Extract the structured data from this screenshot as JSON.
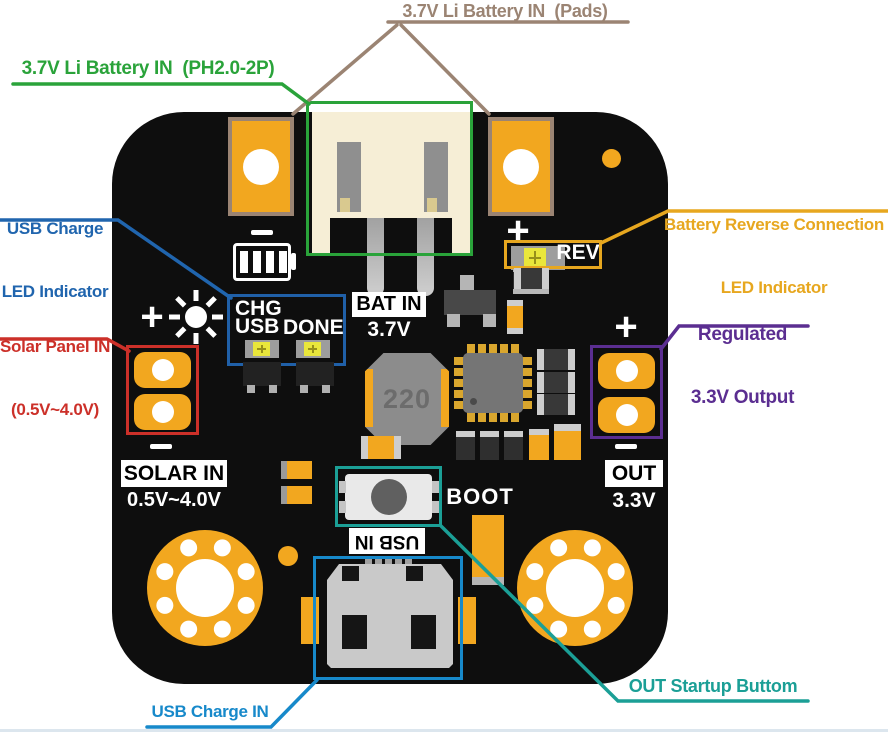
{
  "annotations": {
    "battery_pads": "3.7V Li Battery IN  (Pads)",
    "battery_connector": "3.7V Li Battery IN  (PH2.0-2P)",
    "usb_charge_led_1": "USB Charge",
    "usb_charge_led_2": "LED Indicator",
    "battery_reverse_1": "Battery Reverse Connection",
    "battery_reverse_2": "LED Indicator",
    "solar_panel_1": "Solar Panel IN",
    "solar_panel_2": "(0.5V~4.0V)",
    "regulated_1": "Regulated",
    "regulated_2": "3.3V Output",
    "out_startup": "OUT Startup Buttom",
    "usb_charge_in": "USB Charge IN"
  },
  "silkscreen": {
    "rev": "REV",
    "chg": "CHG",
    "usb": "USB",
    "done": "DONE",
    "bat_in": "BAT IN",
    "bat_voltage": "3.7V",
    "solar_in": "SOLAR IN",
    "solar_range": "0.5V~4.0V",
    "out": "OUT",
    "out_voltage": "3.3V",
    "boot": "BOOT",
    "usb_in": "USB IN",
    "inductor_value": "220",
    "plus": "+"
  },
  "colors": {
    "pcb": "#0e0e0e",
    "pad_orange": "#f2a71f",
    "pad_border_tan": "#9b8473",
    "connector_cream": "#f6eed6",
    "led_yellow": "#e9e63b",
    "callout_tan": "#9b8473",
    "callout_green": "#2aa33a",
    "callout_blue": "#2065ae",
    "callout_orange": "#e7a71f",
    "callout_red": "#cc3029",
    "callout_purple": "#5b2e91",
    "callout_teal": "#1b9f96",
    "callout_lightblue": "#1789ca"
  }
}
